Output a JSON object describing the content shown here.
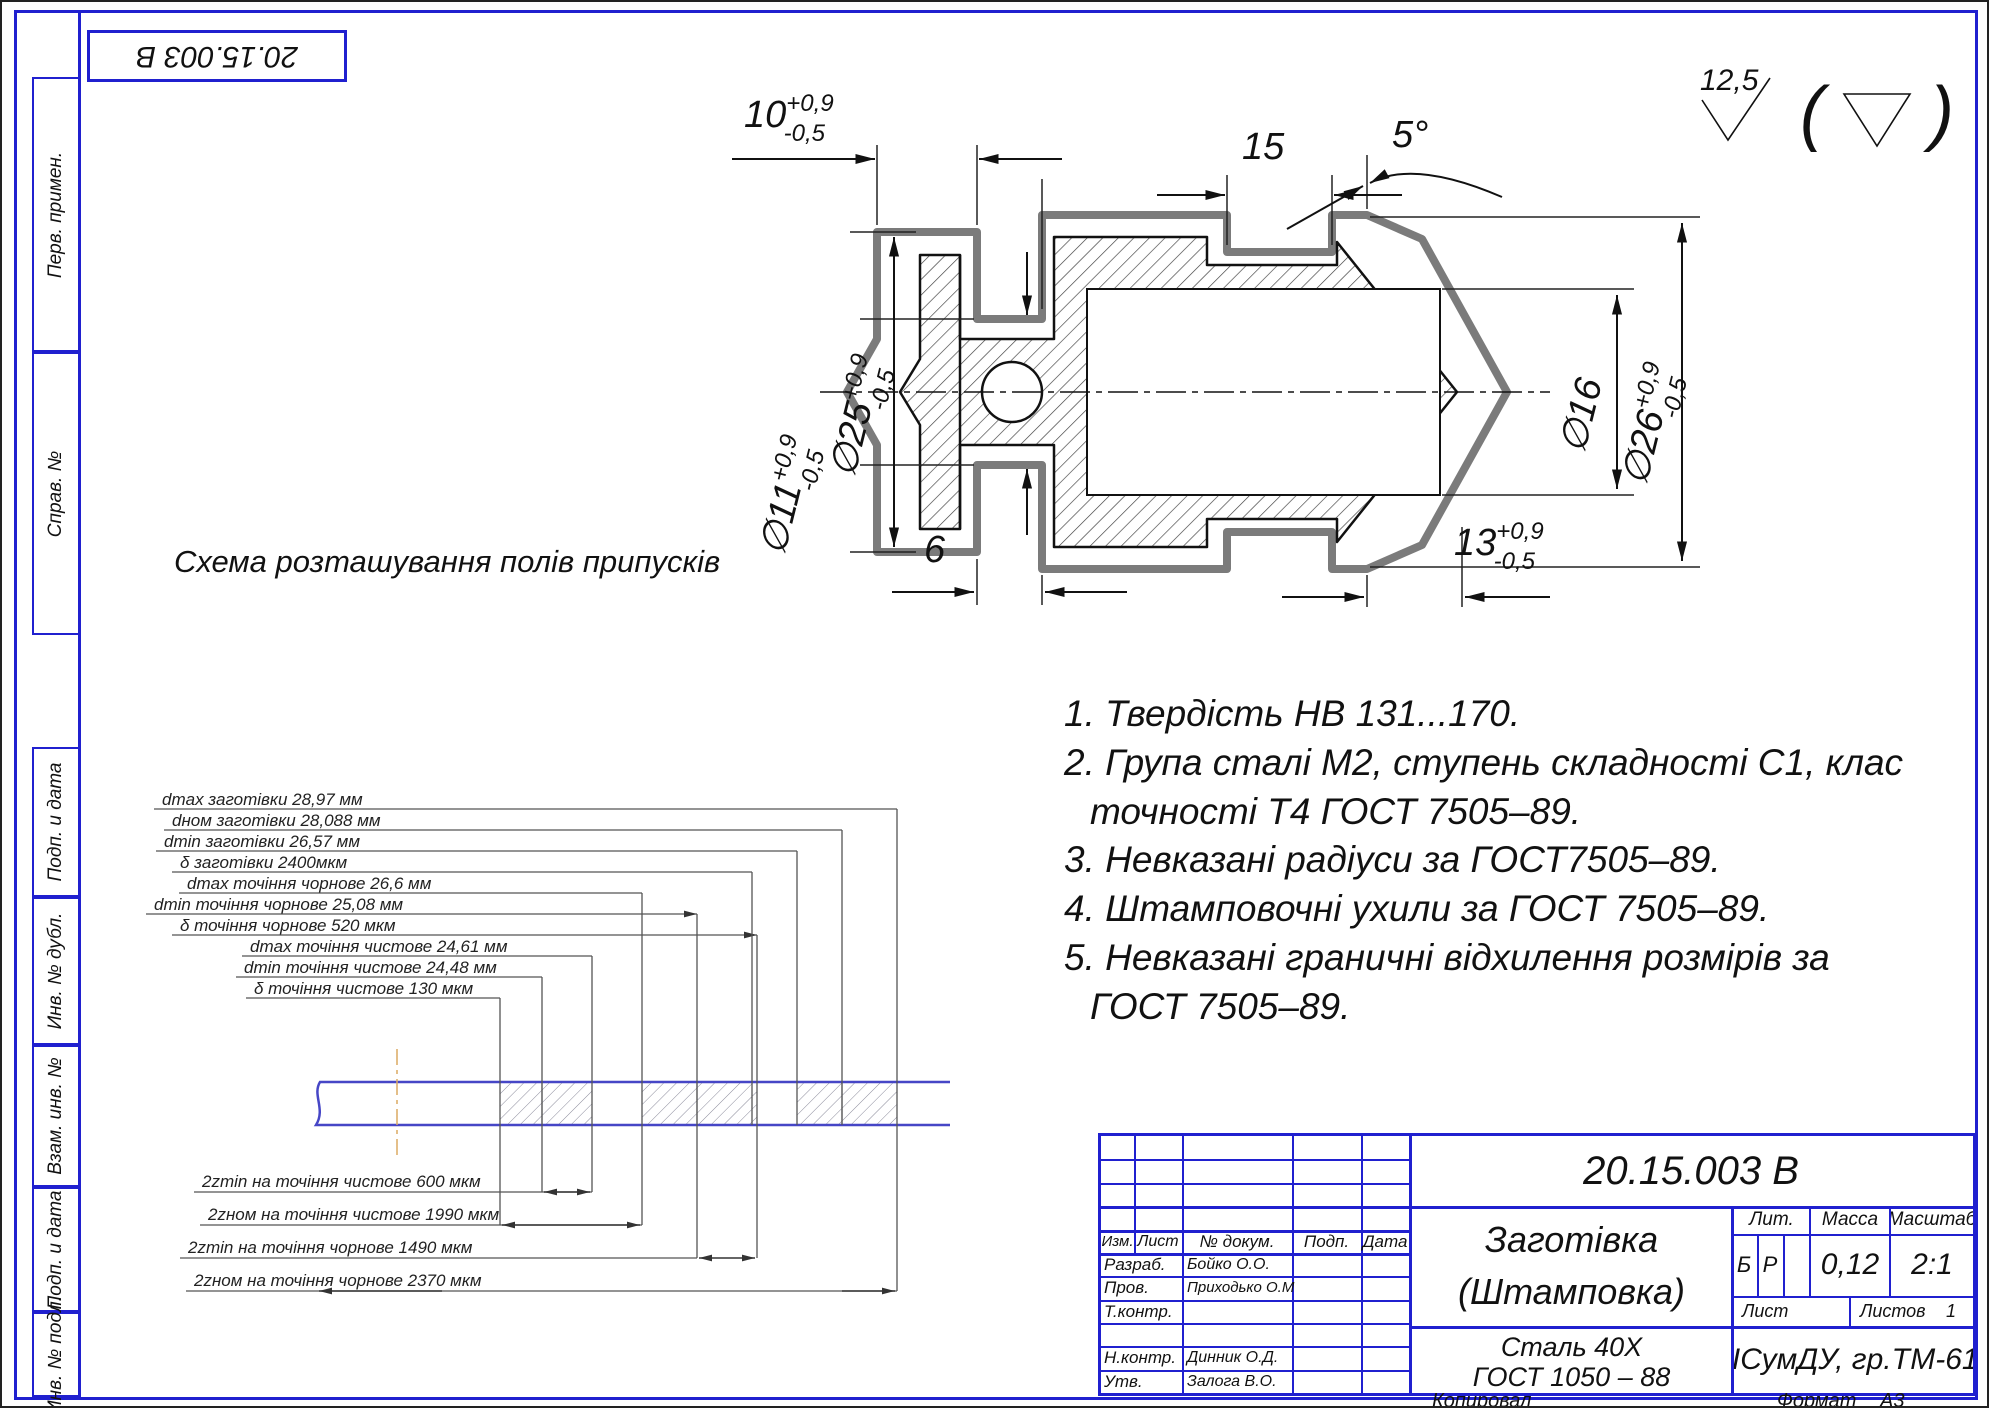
{
  "corner_stamp": {
    "doc_number": "20.15.003 В"
  },
  "side_labels": {
    "s1": "Перв. примен.",
    "s2": "Справ. №",
    "s3": "Подп. и дата",
    "s4": "Инв. № дубл.",
    "s5": "Взам. инв. №",
    "s6": "Подп. и дата",
    "s7": "Инв. № подл."
  },
  "roughness": {
    "value": "12,5"
  },
  "dims": {
    "d10": {
      "v": "10",
      "up": "+0,9",
      "lo": "-0,5"
    },
    "d15": "15",
    "a5": "5°",
    "d25": {
      "v": "∅25",
      "up": "+0,9",
      "lo": "-0,5"
    },
    "d11": {
      "v": "∅11",
      "up": "+0,9",
      "lo": "-0,5"
    },
    "d16": "∅16",
    "d26": {
      "v": "∅26",
      "up": "+0,9",
      "lo": "-0,5"
    },
    "d6": "6",
    "d13": {
      "v": "13",
      "up": "+0,9",
      "lo": "-0,5"
    }
  },
  "scheme": {
    "title": "Схема розташування полів припусків",
    "upper": [
      "dmax заготівки 28,97 мм",
      "dном заготівки 28,088 мм",
      "dmin заготівки 26,57 мм",
      "δ заготівки 2400мкм",
      "dmax точіння чорнове 26,6 мм",
      "dmin точіння чорнове 25,08 мм",
      "δ точіння чорнове 520 мкм",
      "dmax точіння чистове 24,61 мм",
      "dmin точіння чистове 24,48 мм",
      "δ точіння чистове 130 мкм"
    ],
    "lower": [
      "2zmin на точіння чистове 600 мкм",
      "2zном на точіння чистове 1990 мкм",
      "2zmin на точіння чорнове 1490 мкм",
      "2zном на точіння чорнове 2370 мкм"
    ]
  },
  "notes": [
    {
      "t": "1. Твердість НВ 131...170."
    },
    {
      "t": "2. Група сталі М2, ступень складності С1, клас"
    },
    {
      "t": "точності Т4 ГОСТ 7505–89."
    },
    {
      "t": "3. Невказані радіуси за ГОСТ7505–89."
    },
    {
      "t": "4. Штамповочні ухили за ГОСТ 7505–89."
    },
    {
      "t": "5. Невказані граничні відхилення розмірів за"
    },
    {
      "t": "ГОСТ 7505–89."
    }
  ],
  "title_block": {
    "doc_number": "20.15.003 В",
    "cols": {
      "izm": "Изм.",
      "list": "Лист",
      "ndoc": "№ докум.",
      "podp": "Подп.",
      "data": "Дата"
    },
    "rows": [
      {
        "label": "Разраб.",
        "name": "Бойко О.О."
      },
      {
        "label": "Пров.",
        "name": "Приходько О.М."
      },
      {
        "label": "Т.контр.",
        "name": ""
      },
      {
        "label": "",
        "name": ""
      },
      {
        "label": "Н.контр.",
        "name": "Динник О.Д."
      },
      {
        "label": "Утв.",
        "name": "Залога В.О."
      }
    ],
    "part_title_1": "Заготівка",
    "part_title_2": "(Штамповка)",
    "lit_label": "Лит.",
    "lit_1": "Б",
    "lit_2": "Р",
    "mass_label": "Масса",
    "mass_value": "0,12",
    "scale_label": "Масштаб",
    "scale_value": "2:1",
    "sheet_label": "Лист",
    "sheets_label": "Листов",
    "sheets_value": "1",
    "material_1": "Сталь 40Х",
    "material_2": "ГОСТ 1050 – 88",
    "org": "КІСумДУ, гр.ТМ-61к"
  },
  "footer": {
    "copied": "Копировал",
    "format_label": "Формат",
    "format_value": "А3"
  }
}
